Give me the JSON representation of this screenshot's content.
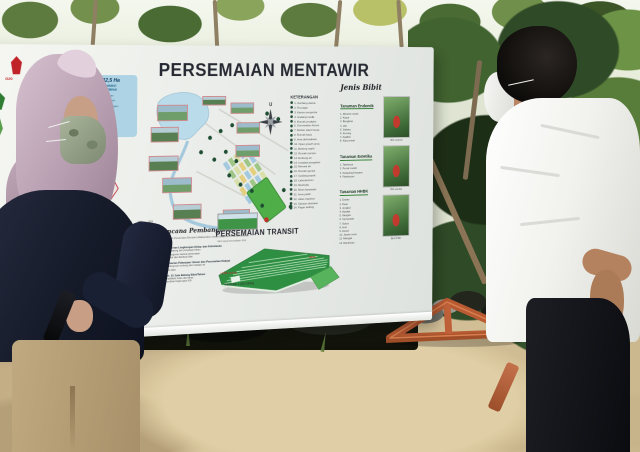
{
  "board": {
    "title": "PERSEMAIAN MENTAWIR",
    "logos": {
      "g20": "G20",
      "g20_sub": "INDONESIA"
    },
    "info_callout": {
      "title": "LUAS 32,5 Ha",
      "cap1": "Kapasitas Produksi:",
      "cap2": "15 juta batang/tahun",
      "loc1": "Lokasi: Kawasan Hutan",
      "loc2": "Produksi, Desa Mentawir,",
      "loc3": "Kec. Sepaku, Kab. Penajam",
      "loc4": "Paser Utara, Kaltim"
    },
    "compass_label": "U",
    "keterangan": {
      "heading": "KETERANGAN",
      "items": [
        "Gerbang utama",
        "Pos jaga",
        "Kantor pengelola",
        "Gudang media",
        "Rumah produksi",
        "Germination house",
        "Mother plant house",
        "Rumah kaca",
        "Area aklimatisasi",
        "Open growth area",
        "Bedeng sapih",
        "Rumah pompa",
        "Embung air",
        "Instalasi pengairan",
        "Menara air",
        "Rumah genset",
        "Gudang pupuk",
        "Laboratorium",
        "Musholla",
        "Mess karyawan",
        "Area parkir",
        "Jalan inspeksi",
        "Saluran drainase",
        "Pagar keliling"
      ]
    },
    "jenis_bibit": {
      "heading": "Jenis Bibit",
      "sections": [
        {
          "title": "Tanaman Endemik",
          "items": [
            "Meranti merah",
            "Kapur",
            "Bangkirai",
            "Ulin",
            "Gaharu",
            "Keruing",
            "Agathis",
            "Kayu mirah"
          ]
        },
        {
          "title": "Tanaman Estetika",
          "items": [
            "Tabebuya",
            "Pucuk merah",
            "Ketapang kencana",
            "Flamboyan"
          ]
        },
        {
          "title": "Tanaman HHBK",
          "items": [
            "Durian",
            "Petai",
            "Jengkol",
            "Alpukat",
            "Nangka",
            "Cempedak",
            "Sukun",
            "Aren",
            "Kemiri",
            "Jambu mete",
            "Mangga",
            "Rambutan"
          ]
        }
      ],
      "photo_captions": [
        "Bibit endemik",
        "Bibit estetika",
        "Bibit HHBK"
      ]
    },
    "rencana": {
      "heading": "Rencana Pembangunan",
      "intro1": "Pembangunan Persemaian Mentawir dilaksanakan",
      "intro2": "melalui kolaborasi lintas kementerian:",
      "items": [
        {
          "no": "1.",
          "title": "Kementerian Lingkungan Hidup dan Kehutanan",
          "subs": [
            "Land clearing dan penyiapan lahan",
            "Pembangunan sarana persemaian",
            "Produksi dan distribusi bibit"
          ]
        },
        {
          "no": "2.",
          "title": "Kementerian Pekerjaan Umum dan Perumahan Rakyat",
          "subs": [
            "Pembangunan embung dan instalasi air",
            "Akses jalan"
          ]
        },
        {
          "no": "3.",
          "title": "Target: 15 Juta Batang Bibit/Tahun",
          "subs": [
            "Rehabilitasi hutan dan lahan",
            "Pemulihan lingkungan IKN"
          ]
        }
      ],
      "table_years": [
        "2021",
        "2022",
        "2023"
      ]
    },
    "transit": {
      "heading": "PERSEMAIAN TRANSIT",
      "subheading": "Aksi cepat penyediaan bibit",
      "area_label": "LUAS ± 0,5 Ha",
      "capacity_label": "Kapasitas: 1 juta batang",
      "mess_label": "MESS"
    },
    "colors": {
      "accent_red": "#c02428",
      "map_green": "#4fae47",
      "map_water": "#badbe9",
      "callout_blue": "#aed3e4",
      "easel_wood": "#c06038"
    }
  }
}
